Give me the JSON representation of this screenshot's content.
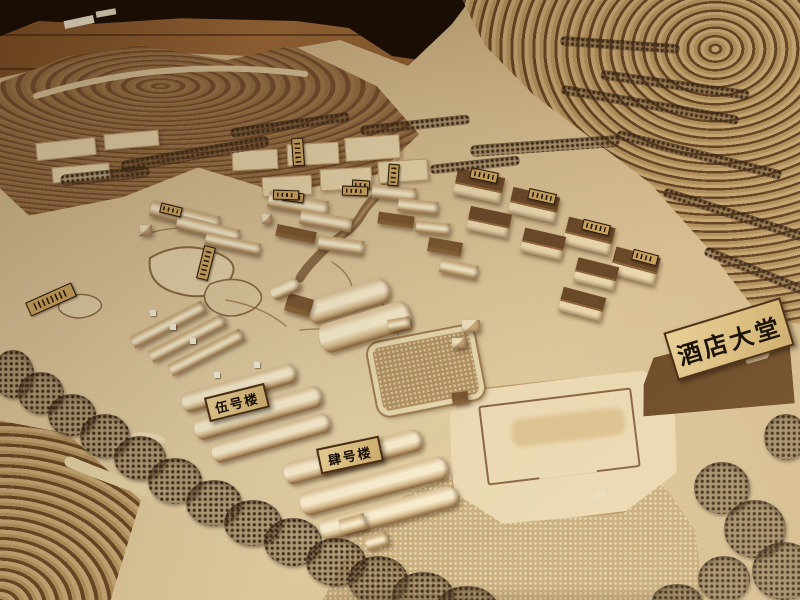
{
  "scene": {
    "description": "Photograph of a wooden architectural scale model of a terraced hillside resort",
    "signs": {
      "hotel_lobby_label": "酒店大堂",
      "building5_label": "伍号楼",
      "building4_label": "肆号楼"
    },
    "palette": {
      "terrain_light": "#e3d0a6",
      "terrain_dark": "#a9885c",
      "hill_wood": "#72482a",
      "terrace_line": "#684625",
      "building_light": "#f4e8c8",
      "roof_dark": "#6b4a2a",
      "tree_dark": "#46321d",
      "table_dark": "#190d04",
      "floor_wood": "#a06c3a",
      "sign_bg": "#dcbd84",
      "sign_text": "#160d03",
      "water_sparkle": "#c9ae7e"
    }
  }
}
